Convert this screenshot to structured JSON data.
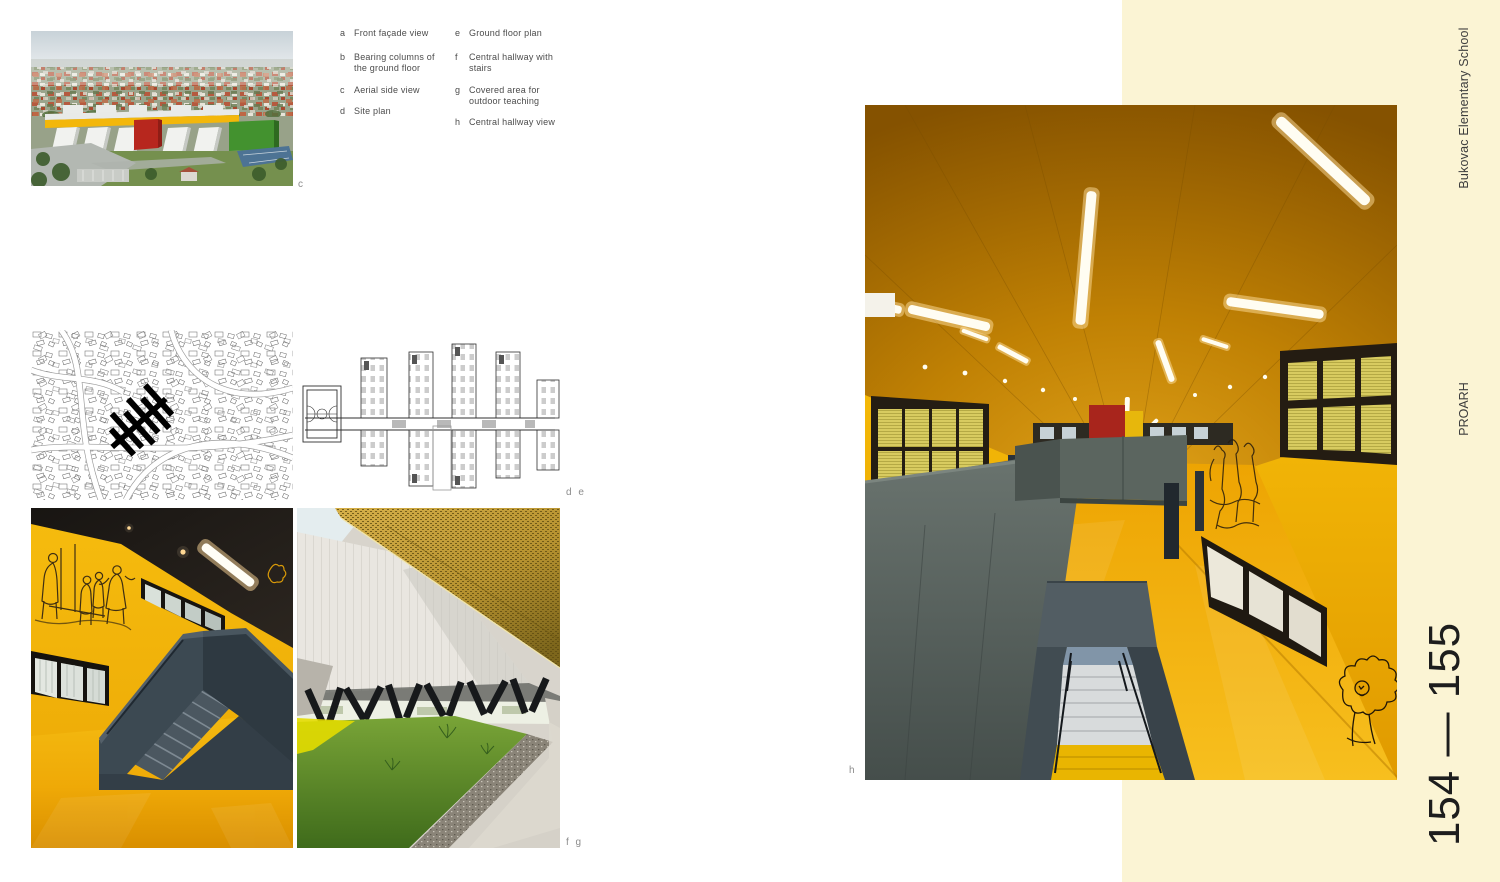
{
  "page": {
    "background": "#ffffff",
    "accent_band_color": "#fbf4d4"
  },
  "captions": {
    "column1": [
      {
        "letter": "a",
        "text": "Front façade view"
      },
      {
        "letter": "b",
        "text": "Bearing columns of the ground floor"
      },
      {
        "letter": "c",
        "text": "Aerial side view"
      },
      {
        "letter": "d",
        "text": "Site plan"
      }
    ],
    "column2": [
      {
        "letter": "e",
        "text": "Ground floor plan"
      },
      {
        "letter": "f",
        "text": "Central hallway with stairs"
      },
      {
        "letter": "g",
        "text": "Covered area for outdoor teaching"
      },
      {
        "letter": "h",
        "text": "Central hallway view"
      }
    ]
  },
  "figure_labels": {
    "aerial": "c",
    "plans": "d e",
    "interiors": "f g",
    "hallway": "h"
  },
  "sidebar": {
    "project_title": "Bukovac Elementary School",
    "architect": "PROARH",
    "page_numbers": "154 — 155"
  },
  "palette": {
    "school_yellow": "#F2B20A",
    "slate_gray": "#4C585F",
    "canopy_gold": "#C3A035",
    "accent_red": "#B0271E",
    "facade_white": "#EDEDEB",
    "band_pale_yellow": "#FBF4D4"
  }
}
